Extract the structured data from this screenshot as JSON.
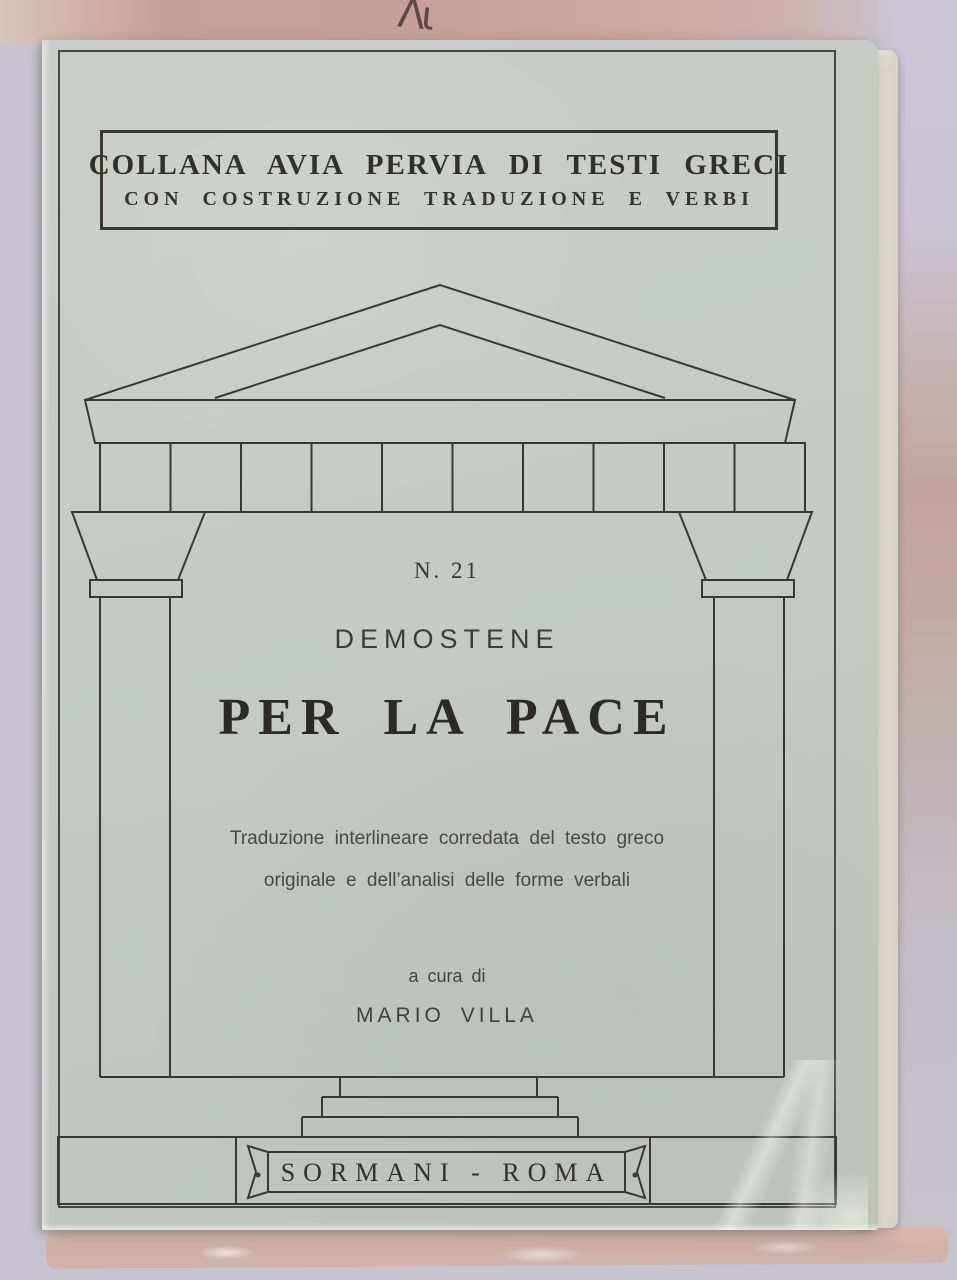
{
  "photo": {
    "handwriting_marks": "Λι"
  },
  "colors": {
    "paper": "#c5cac4",
    "ink": "#3a3832",
    "top_band": "#c5a09a",
    "bg_right_top": "#cbc7d5",
    "bg_right_mid": "#c2a49d",
    "bg_bottom": "#c8c4cf",
    "pages_edge": "#ebe7db",
    "behind_book_edge": "#d9bcae"
  },
  "cover": {
    "series_box": {
      "line1": "COLLANA AVIA PERVIA DI TESTI GRECI",
      "line2": "CON COSTRUZIONE TRADUZIONE E VERBI"
    },
    "number": "N. 21",
    "author": "DEMOSTENE",
    "title": "PER LA PACE",
    "subtitle": {
      "line1": "Traduzione interlineare corredata del testo greco",
      "line2": "originale e dell’analisi delle forme verbali"
    },
    "edited_by_label": "a cura di",
    "editor": "MARIO VILLA",
    "publisher": "SORMANI - ROMA",
    "illustration": "greek-temple-line-drawing"
  }
}
